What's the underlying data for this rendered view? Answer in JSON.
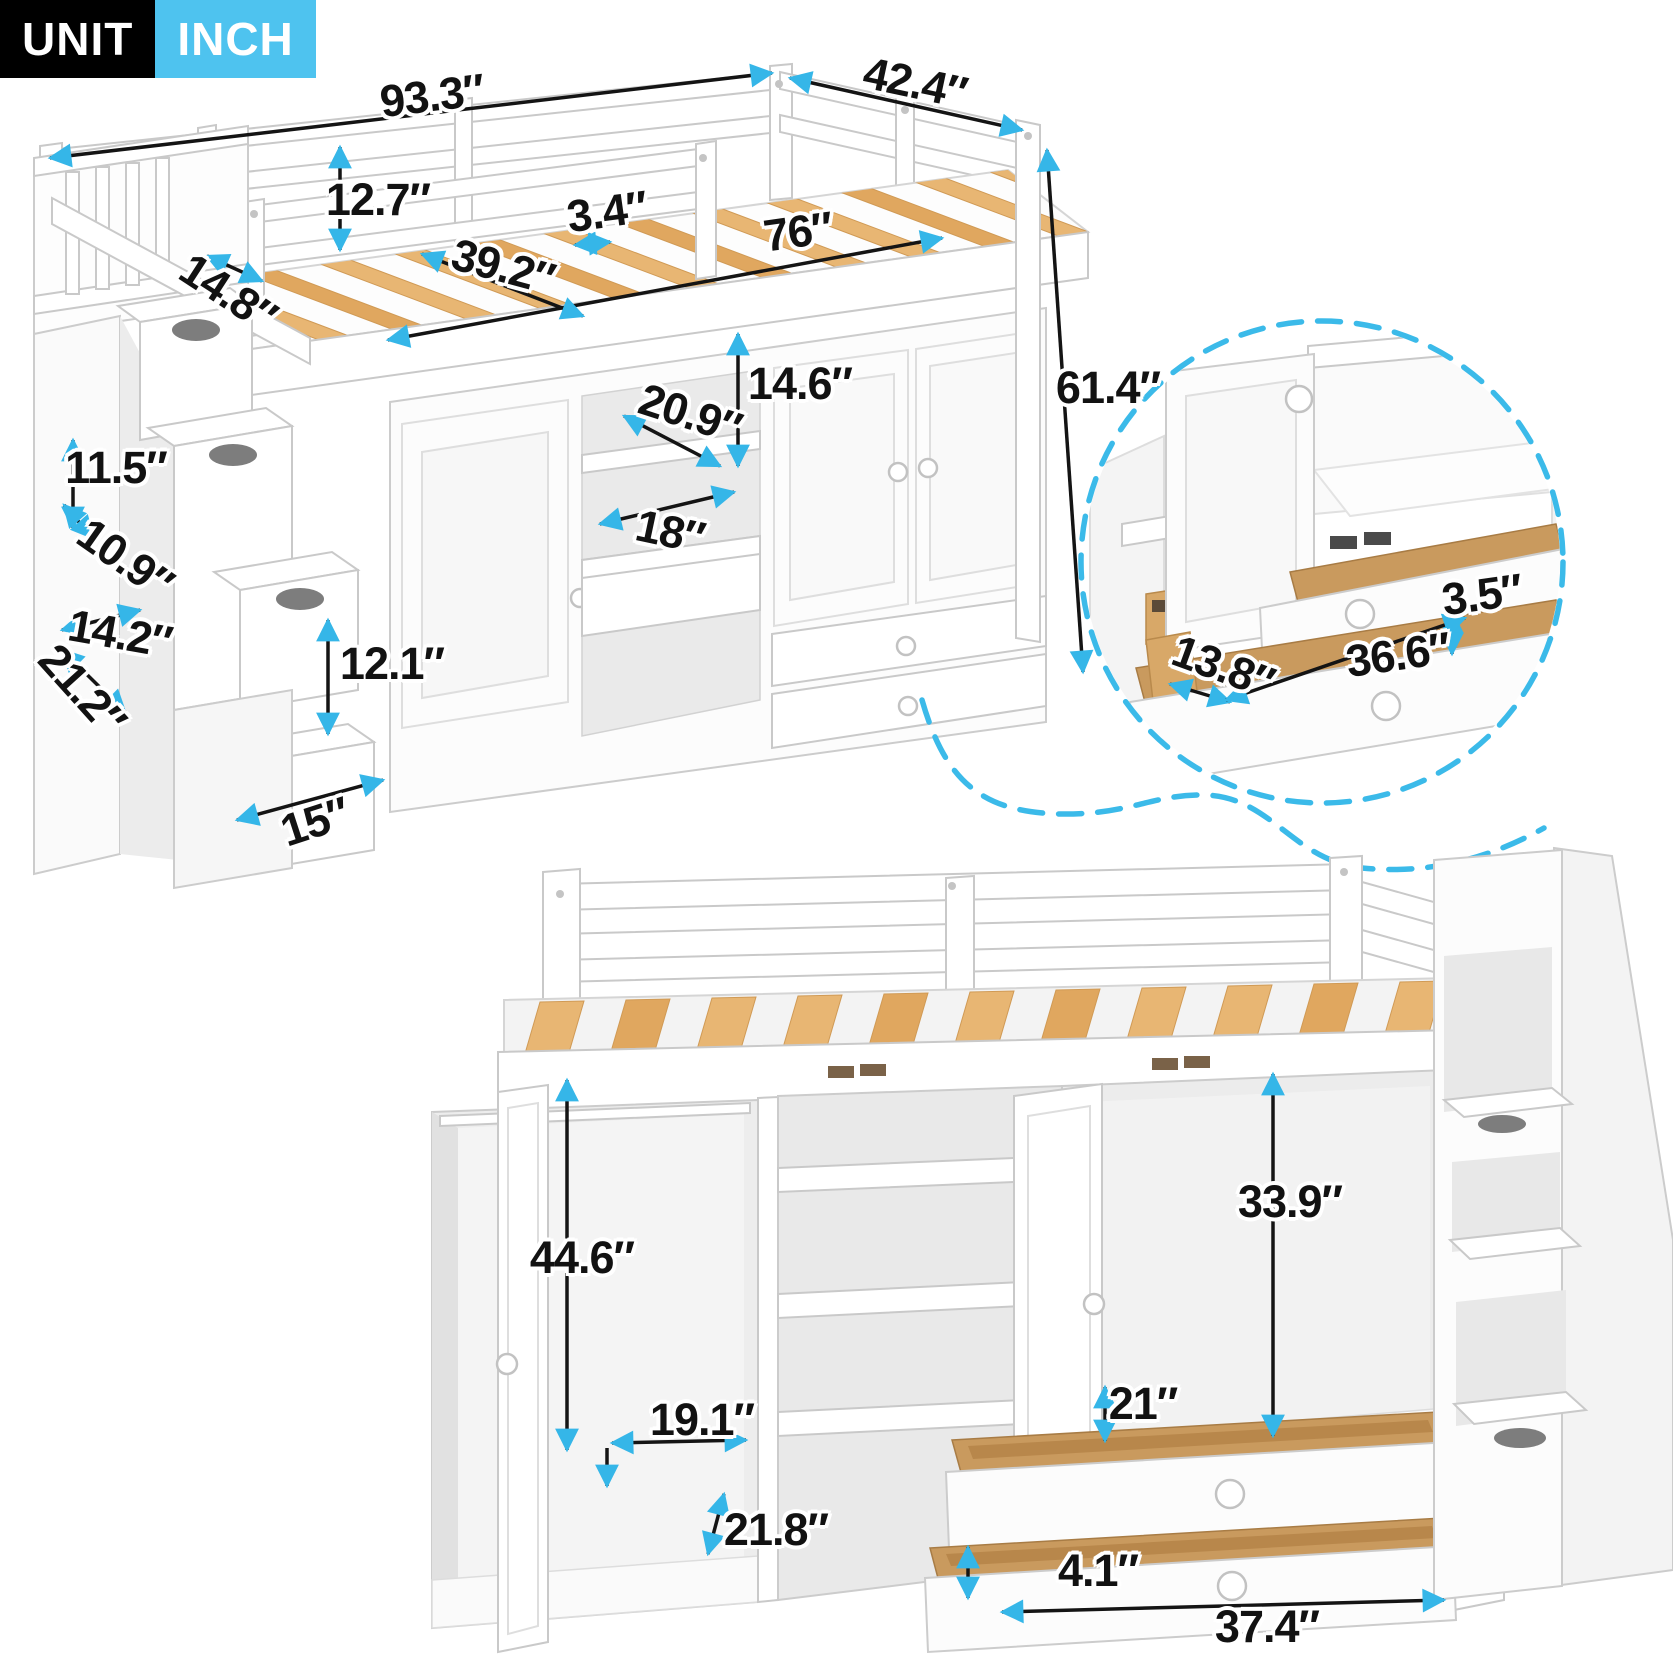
{
  "badge": {
    "unit_label": "UNIT",
    "unit_value": "INCH"
  },
  "colors": {
    "accent_arrow": "#35b6e8",
    "dashed_accent": "#3bbae9",
    "badge_unit_bg": "#000000",
    "badge_inch_bg": "#4ec3ef",
    "wood_slat": "#e8b673",
    "drawer_wood": "#c99a5e",
    "dimension_line": "#141414"
  },
  "main_view": {
    "name": "Loft bed with storage staircase and wardrobe - assembled isometric view",
    "dimensions": {
      "overall_length": {
        "label": "93.3″",
        "value": 93.3
      },
      "overall_width": {
        "label": "42.4″",
        "value": 42.4
      },
      "guardrail_height": {
        "label": "12.7″",
        "value": 12.7
      },
      "slat_gap": {
        "label": "3.4″",
        "value": 3.4
      },
      "sleep_length": {
        "label": "76″",
        "value": 76
      },
      "sleep_width": {
        "label": "39.2″",
        "value": 39.2
      },
      "stair_landing_depth": {
        "label": "14.8″",
        "value": 14.8
      },
      "upper_cubby_height": {
        "label": "14.6″",
        "value": 14.6
      },
      "cubby_depth": {
        "label": "20.9″",
        "value": 20.9
      },
      "cubby_width": {
        "label": "18″",
        "value": 18
      },
      "stair_rail_height": {
        "label": "11.5″",
        "value": 11.5
      },
      "step_tread_depth": {
        "label": "10.9″",
        "value": 10.9
      },
      "step_width": {
        "label": "14.2″",
        "value": 14.2
      },
      "stair_side_depth": {
        "label": "21.2″",
        "value": 21.2
      },
      "step_box_height": {
        "label": "12.1″",
        "value": 12.1
      },
      "bottom_step_width": {
        "label": "15″",
        "value": 15
      },
      "overall_height": {
        "label": "61.4″",
        "value": 61.4
      }
    }
  },
  "detail_view": {
    "name": "Storage drawers pulled out - magnified detail circle",
    "dimensions": {
      "drawer_inner_height": {
        "label": "3.5″",
        "value": 3.5
      },
      "drawer_inner_depth": {
        "label": "13.8″",
        "value": 13.8
      },
      "drawer_inner_width": {
        "label": "36.6″",
        "value": 36.6
      }
    }
  },
  "open_view": {
    "name": "Loft bed with wardrobe doors and drawers open - front view",
    "dimensions": {
      "wardrobe_inner_height": {
        "label": "44.6″",
        "value": 44.6
      },
      "right_inner_height": {
        "label": "33.9″",
        "value": 33.9
      },
      "drawer_compartment_height": {
        "label": "21″",
        "value": 21
      },
      "left_inner_width": {
        "label": "19.1″",
        "value": 19.1
      },
      "inner_depth": {
        "label": "21.8″",
        "value": 21.8
      },
      "drawer_front_height": {
        "label": "4.1″",
        "value": 4.1
      },
      "drawer_width": {
        "label": "37.4″",
        "value": 37.4
      }
    }
  }
}
